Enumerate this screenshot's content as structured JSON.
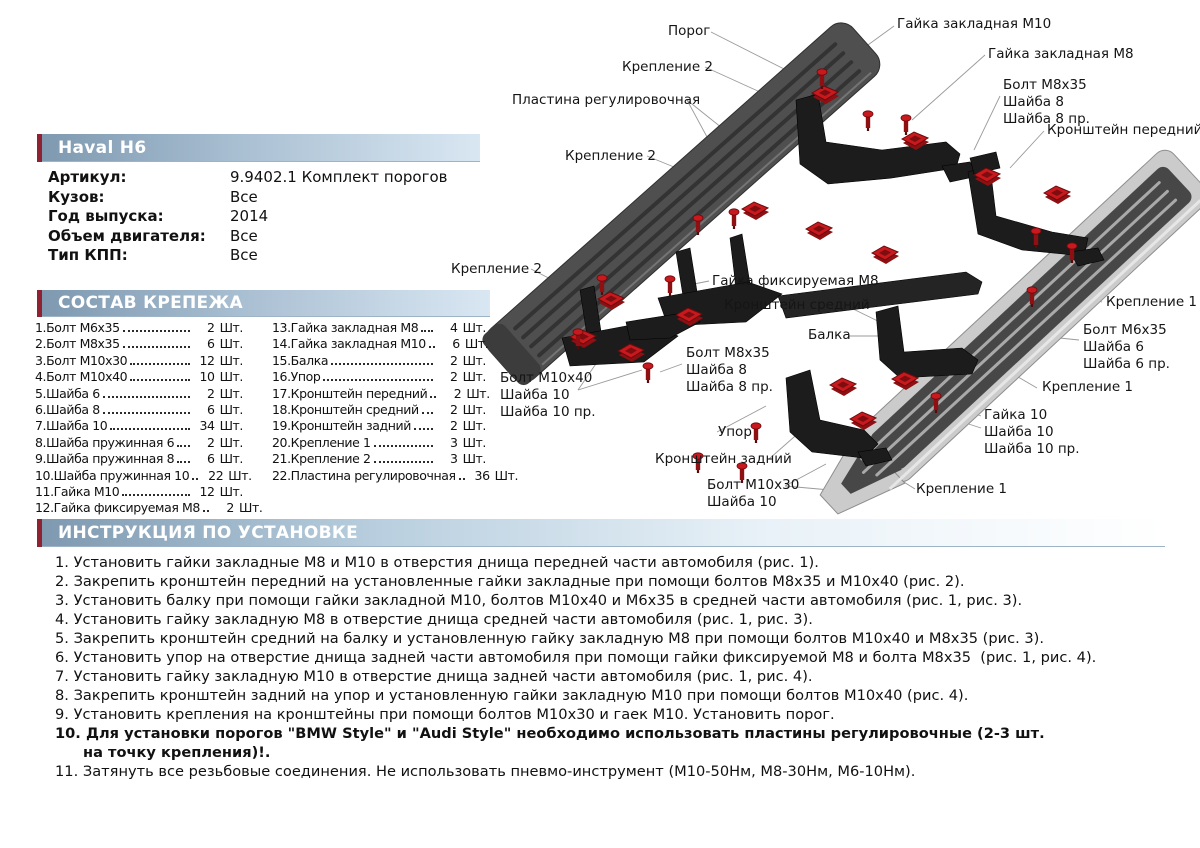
{
  "product": {
    "title": "Haval H6",
    "specs": [
      {
        "label": "Артикул:",
        "value": "9.9402.1 Комплект порогов"
      },
      {
        "label": "Кузов:",
        "value": "Все"
      },
      {
        "label": "Год выпуска:",
        "value": "2014"
      },
      {
        "label": "Объем двигателя:",
        "value": "Все"
      },
      {
        "label": "Тип КПП:",
        "value": "Все"
      }
    ]
  },
  "fasteners": {
    "title": "СОСТАВ КРЕПЕЖА",
    "unit": "Шт.",
    "left": [
      {
        "name": "1.Болт М6х35",
        "qty": "2"
      },
      {
        "name": "2.Болт М8х35",
        "qty": "6"
      },
      {
        "name": "3.Болт М10х30",
        "qty": "12"
      },
      {
        "name": "4.Болт М10х40",
        "qty": "10"
      },
      {
        "name": "5.Шайба 6",
        "qty": "2"
      },
      {
        "name": "6.Шайба 8",
        "qty": "6"
      },
      {
        "name": "7.Шайба 10",
        "qty": "34"
      },
      {
        "name": "8.Шайба пружинная 6",
        "qty": "2"
      },
      {
        "name": "9.Шайба пружинная 8",
        "qty": "6"
      },
      {
        "name": "10.Шайба пружинная 10",
        "qty": "22"
      },
      {
        "name": "11.Гайка М10",
        "qty": "12"
      },
      {
        "name": "12.Гайка фиксируемая М8",
        "qty": "2"
      }
    ],
    "right": [
      {
        "name": "13.Гайка закладная М8",
        "qty": "4"
      },
      {
        "name": "14.Гайка закладная М10",
        "qty": "6"
      },
      {
        "name": "15.Балка",
        "qty": "2"
      },
      {
        "name": "16.Упор",
        "qty": "2"
      },
      {
        "name": "17.Кронштейн передний",
        "qty": "2"
      },
      {
        "name": "18.Кронштейн средний",
        "qty": "2"
      },
      {
        "name": "19.Кронштейн задний",
        "qty": "2"
      },
      {
        "name": "20.Крепление 1",
        "qty": "3"
      },
      {
        "name": "21.Крепление 2",
        "qty": "3"
      },
      {
        "name": "22.Пластина регулировочная",
        "qty": "36"
      }
    ]
  },
  "instructions": {
    "title": "ИНСТРУКЦИЯ ПО УСТАНОВКЕ",
    "steps": [
      {
        "num": "1.",
        "text": "Установить гайки закладные М8 и М10 в отверстия днища передней части автомобиля (рис. 1).",
        "bold": false
      },
      {
        "num": "2.",
        "text": "Закрепить кронштейн передний на установленные гайки закладные при помощи болтов М8х35 и М10х40 (рис. 2).",
        "bold": false
      },
      {
        "num": "3.",
        "text": "Установить балку при помощи гайки закладной М10, болтов М10х40 и М6х35 в средней части автомобиля (рис. 1, рис. 3).",
        "bold": false
      },
      {
        "num": "4.",
        "text": "Установить гайку закладную М8 в отверстие днища средней части автомобиля (рис. 1, рис. 3).",
        "bold": false
      },
      {
        "num": "5.",
        "text": "Закрепить кронштейн средний на балку и установленную гайку закладную М8 при помощи болтов М10х40 и М8х35 (рис. 3).",
        "bold": false
      },
      {
        "num": "6.",
        "text": "Установить упор на отверстие днища задней части автомобиля при помощи гайки фиксируемой М8 и болта М8х35  (рис. 1, рис. 4).",
        "bold": false
      },
      {
        "num": "7.",
        "text": "Установить гайку закладную М10 в отверстие днища задней части автомобиля (рис. 1, рис. 4).",
        "bold": false
      },
      {
        "num": "8.",
        "text": "Закрепить кронштейн задний на упор и установленную гайки закладную М10 при помощи болтов М10х40 (рис. 4).",
        "bold": false
      },
      {
        "num": "9.",
        "text": "Установить крепления на кронштейны при помощи болтов М10х30 и гаек М10. Установить порог.",
        "bold": false
      },
      {
        "num": "10.",
        "text": "Для установки порогов \"BMW Style\" и \"Audi Style\" необходимо использовать пластины регулировочные (2-3 шт.\nна точку крепления)!.",
        "bold": true
      },
      {
        "num": "11.",
        "text": "Затянуть все резьбовые соединения. Не использовать пневмо-инструмент (М10-50Нм, М8-30Нм, М6-10Нм).",
        "bold": false
      }
    ]
  },
  "diagram": {
    "callouts": [
      {
        "text": "Порог"
      },
      {
        "text": "Гайка закладная М10"
      },
      {
        "text": "Крепление 2"
      },
      {
        "text": "Гайка закладная М8"
      },
      {
        "text": "Пластина регулировочная"
      },
      {
        "text": "Болт М8х35"
      },
      {
        "text": "Шайба 8"
      },
      {
        "text": "Шайба 8 пр."
      },
      {
        "text": "Кронштейн передний"
      },
      {
        "text": "Крепление 2"
      },
      {
        "text": "Крепление 2"
      },
      {
        "text": "Гайка фиксируемая М8"
      },
      {
        "text": "Кронштейн средний"
      },
      {
        "text": "Балка"
      },
      {
        "text": "Крепление 1"
      },
      {
        "text": "Болт М6х35"
      },
      {
        "text": "Шайба 6"
      },
      {
        "text": "Шайба 6 пр."
      },
      {
        "text": "Болт М8х35"
      },
      {
        "text": "Шайба 8"
      },
      {
        "text": "Шайба 8 пр."
      },
      {
        "text": "Болт М10х40"
      },
      {
        "text": "Шайба 10"
      },
      {
        "text": "Шайба 10 пр."
      },
      {
        "text": "Крепление 1"
      },
      {
        "text": "Гайка 10"
      },
      {
        "text": "Шайба 10"
      },
      {
        "text": "Шайба 10 пр."
      },
      {
        "text": "Упор"
      },
      {
        "text": "Кронштейн задний"
      },
      {
        "text": "Болт М10х30"
      },
      {
        "text": "Шайба 10"
      },
      {
        "text": "Крепление 1"
      }
    ]
  },
  "colors": {
    "accent_red": "#8e2232",
    "bar_blue": "#7e99b0",
    "part_red": "#c8191e",
    "bracket_black": "#1c1c1c",
    "board_dark": "#4f4f4f",
    "board_silver": "#cbcbcb"
  }
}
